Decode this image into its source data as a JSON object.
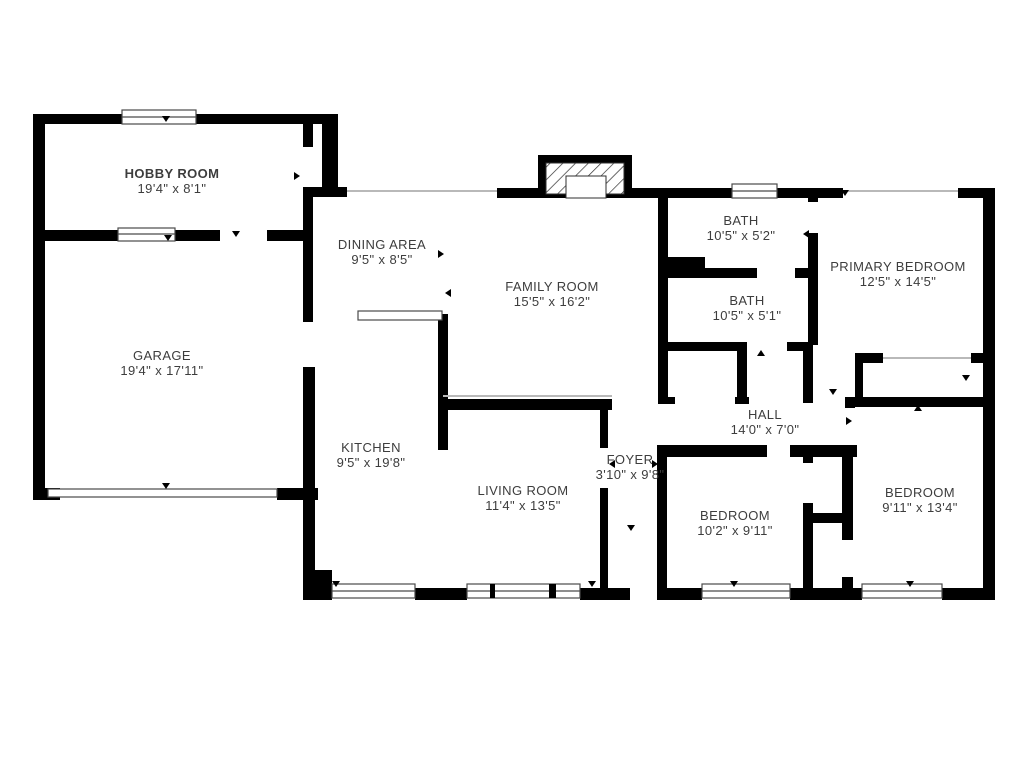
{
  "figure": {
    "kind_label": "floor-plan"
  },
  "colors": {
    "wall": "#000000",
    "label_text": "#3d3d3d",
    "window_stroke": "#4a4a4a",
    "thin_opening": "#b9b9b9",
    "background": "#ffffff"
  },
  "rooms": [
    {
      "name": "HOBBY ROOM",
      "dims": "19'4\" x 8'1\""
    },
    {
      "name": "GARAGE",
      "dims": "19'4\" x 17'11\""
    },
    {
      "name": "DINING AREA",
      "dims": "9'5\" x 8'5\""
    },
    {
      "name": "FAMILY ROOM",
      "dims": "15'5\" x 16'2\""
    },
    {
      "name": "BATH",
      "dims": "10'5\" x 5'2\""
    },
    {
      "name": "BATH",
      "dims": "10'5\" x 5'1\""
    },
    {
      "name": "PRIMARY BEDROOM",
      "dims": "12'5\" x 14'5\""
    },
    {
      "name": "KITCHEN",
      "dims": "9'5\" x 19'8\""
    },
    {
      "name": "LIVING ROOM",
      "dims": "11'4\" x 13'5\""
    },
    {
      "name": "FOYER",
      "dims": "3'10\" x 9'8\""
    },
    {
      "name": "HALL",
      "dims": "14'0\" x 7'0\""
    },
    {
      "name": "BEDROOM",
      "dims": "10'2\" x 9'11\""
    },
    {
      "name": "BEDROOM",
      "dims": "9'11\" x 13'4\""
    }
  ]
}
